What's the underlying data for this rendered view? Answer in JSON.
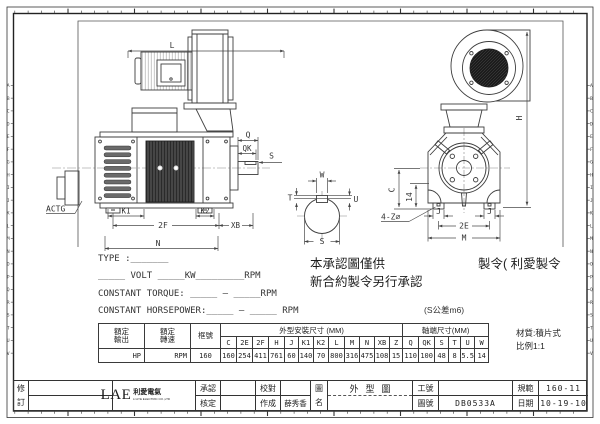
{
  "frame": {
    "zone_letters": "ABCDEFGHIJKLMNOPQRSTUV"
  },
  "side_view": {
    "l": "L",
    "q": "Q",
    "qk": "QK",
    "s": "S",
    "actg": "ACTG",
    "k1": "K1",
    "k2": "K2",
    "f2": "2F",
    "xb": "XB",
    "n": "N"
  },
  "shaft_section": {
    "w": "W",
    "t": "T",
    "u": "U",
    "s": "S"
  },
  "front_view": {
    "h": "H",
    "c": "C",
    "d14": "14",
    "holes": "4-Z∅",
    "j_left": "J",
    "j_right": "J",
    "e2": "2E",
    "m": "M"
  },
  "spec_lines": {
    "type": "TYPE :_______",
    "volt": "_____ VOLT _____KW_________RPM",
    "torque": "CONSTANT TORQUE: _____ — _____RPM",
    "horsepower": "CONSTANT HORSEPOWER:_____ — _____ RPM"
  },
  "notes": {
    "line1_left": "本承認圖僅供",
    "line1_right": "製令( 利愛製令",
    "line2": "新合約製令另行承認",
    "shaft_tolerance": "(S公差m6)",
    "material": "材質:積片式",
    "scale": "比例1:1"
  },
  "dim_table": {
    "rated_output": "額定輸出",
    "rated_speed": "額定轉速",
    "frame_no": "框號",
    "outline_header": "外型安裝尺寸 (MM)",
    "shaft_header": "軸端尺寸(MM)",
    "dims": [
      "C",
      "2E",
      "2F",
      "H",
      "J",
      "K1",
      "K2",
      "L",
      "M",
      "N",
      "XB",
      "Z",
      "Q",
      "QK",
      "S",
      "T",
      "U",
      "W"
    ],
    "values": [
      "160",
      "254",
      "411",
      "761",
      "60",
      "140",
      "70",
      "800",
      "316",
      "475",
      "108",
      "15",
      "110",
      "100",
      "48",
      "8",
      "5.5",
      "14"
    ],
    "output_value": "HP",
    "speed_value": "RPM",
    "frame_value": "160"
  },
  "title_block": {
    "revision_label": "修訂",
    "logo_text": "LAE",
    "logo_cn": "利愛電氣",
    "logo_sub": "LI AYE ELECTRIC CO.,LTD",
    "approve_label": "承認",
    "verify_label": "核定",
    "proof_label": "校對",
    "made_label": "作成",
    "made_by": "薛秀香",
    "drawing_name_label": "圖名",
    "drawing_name": "外型圖",
    "work_no_label": "工號",
    "drawing_no_label": "圖號",
    "drawing_no": "DB0533A",
    "spec_label": "規範",
    "spec_value": "160-11",
    "date_label": "日期",
    "date_value": "10-19-10"
  }
}
